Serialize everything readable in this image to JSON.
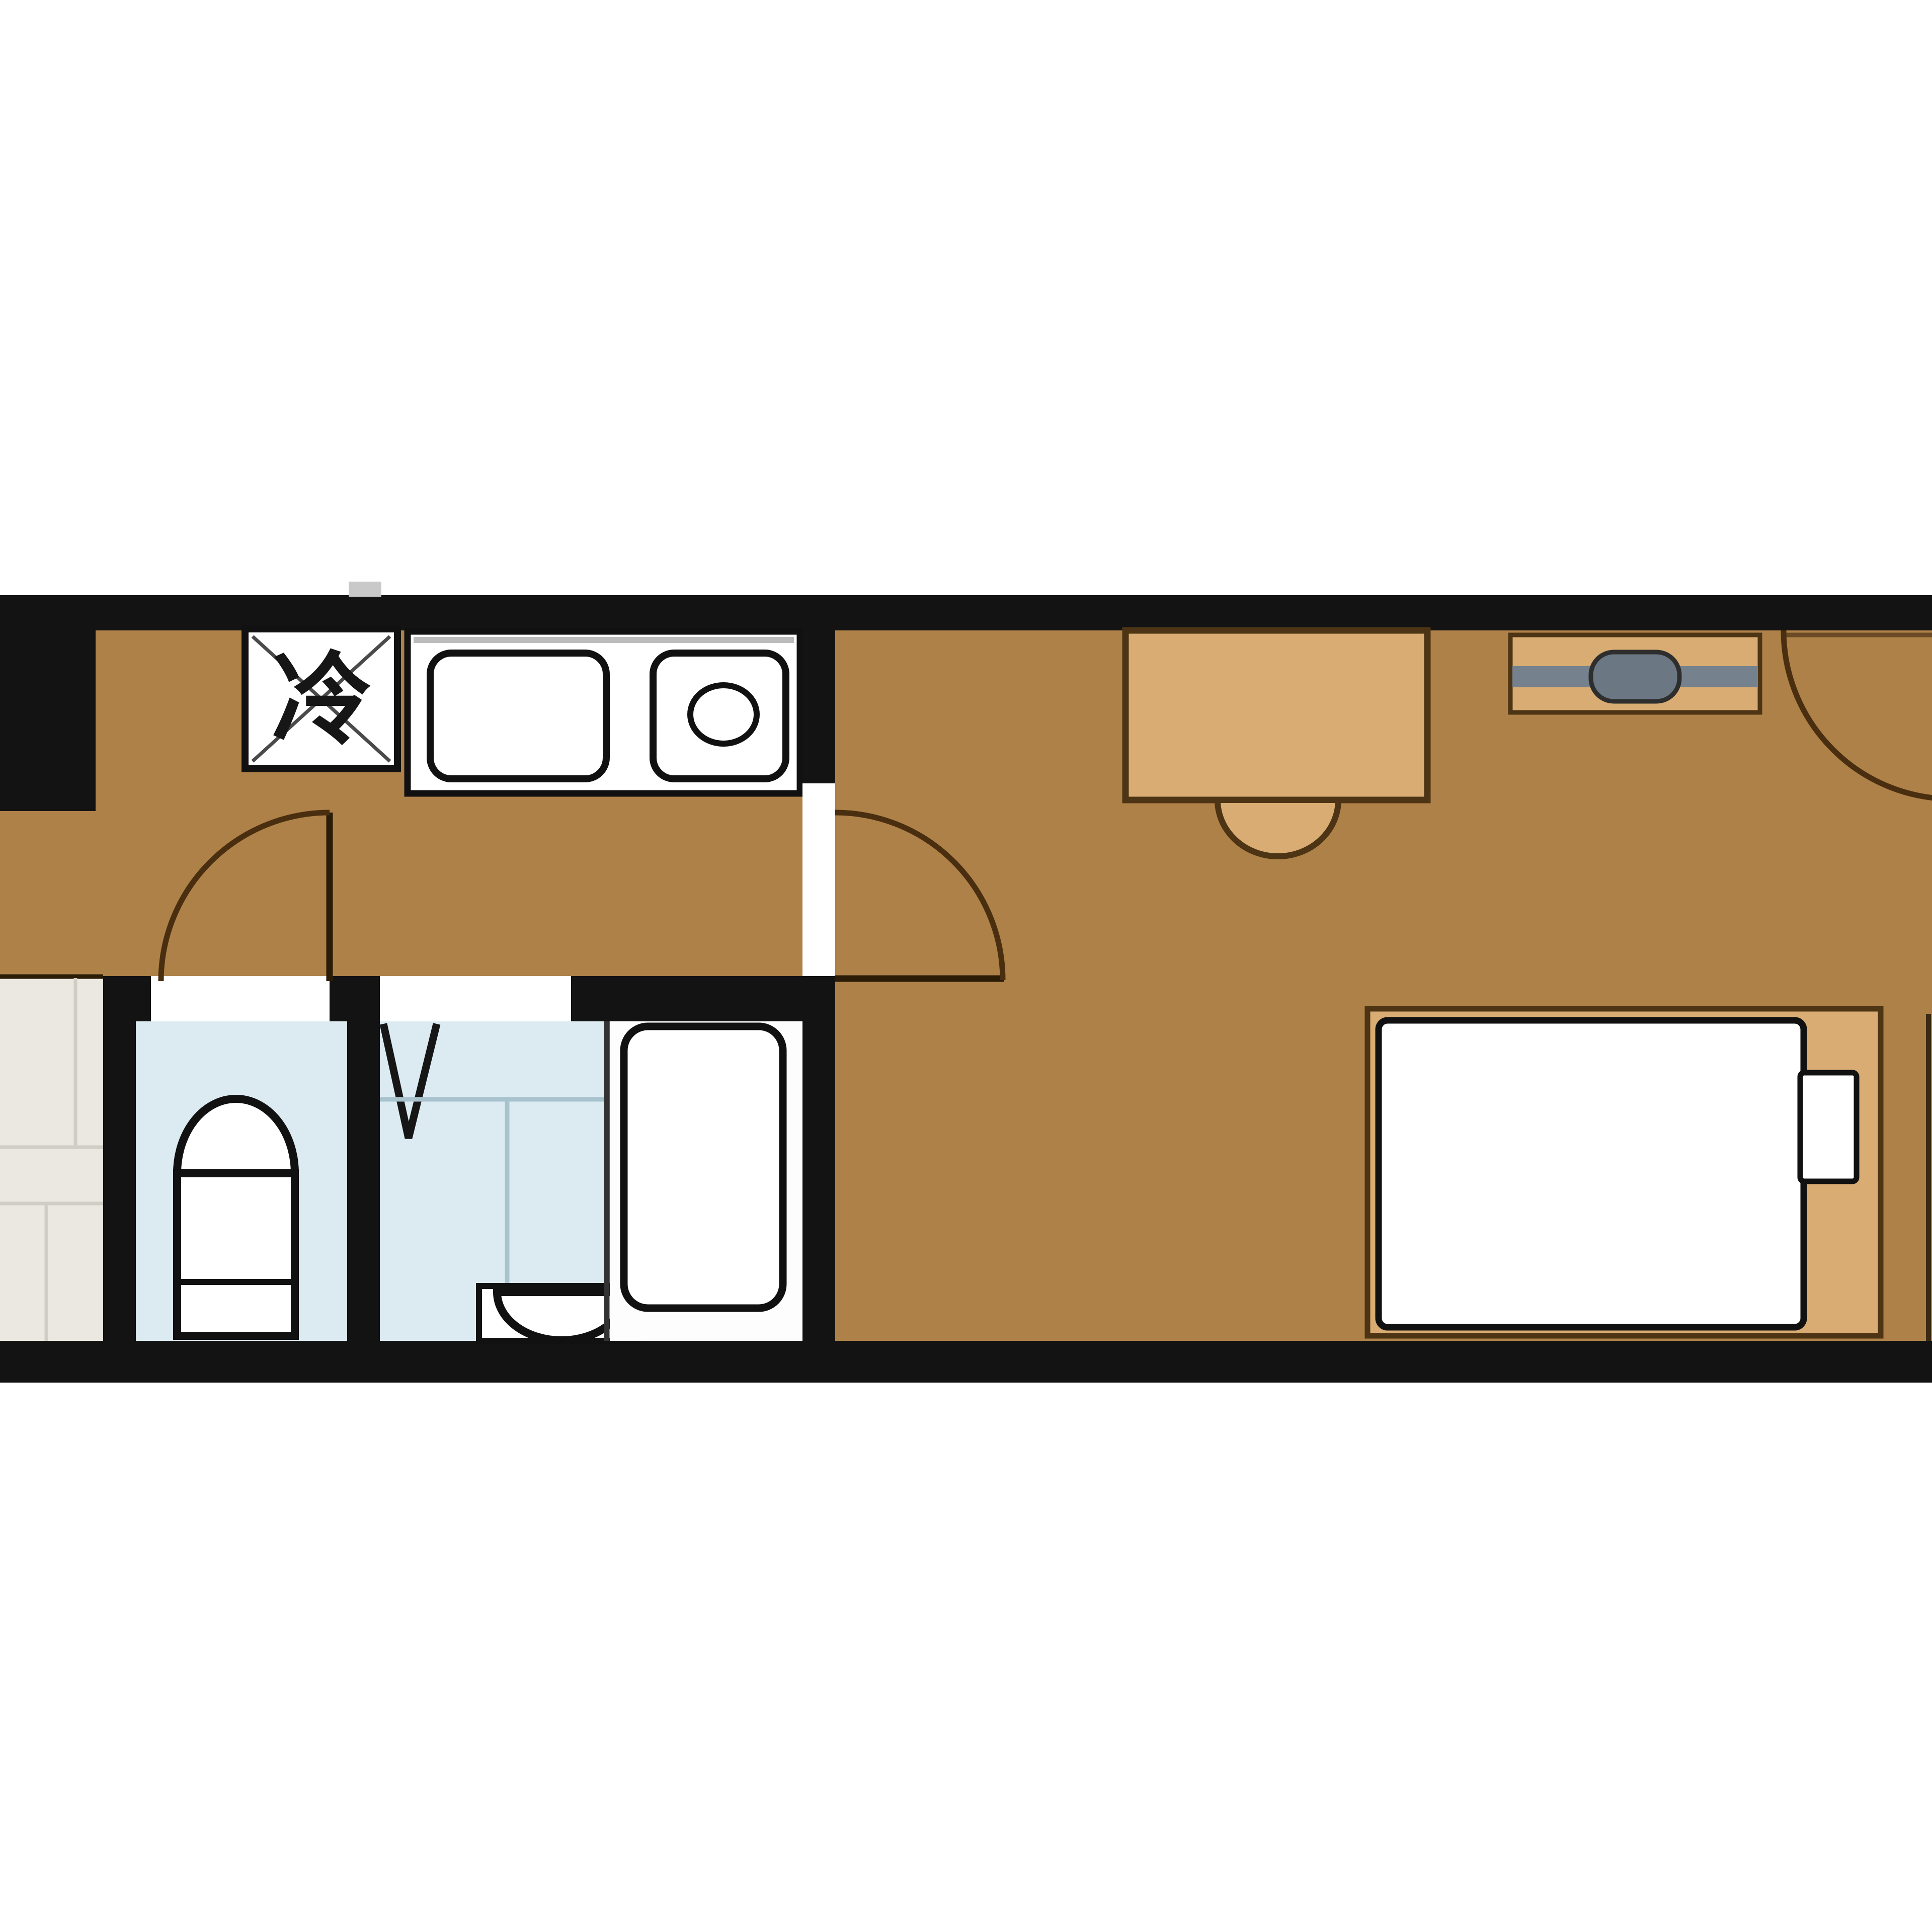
{
  "labels": {
    "refrigerator": "冷"
  },
  "colors": {
    "background": "#ffffff",
    "wall": "#131313",
    "floor": "#ae8148",
    "furniture": "#d8ac72",
    "furniture_border": "#4d3414",
    "door_arc": "#4a2e10",
    "wet_area": "#dcebf1",
    "wet_line": "#a9c3ce",
    "bath_floor": "#fdfdfd",
    "fixture": "#ffffff",
    "fixture_border": "#111111",
    "tile": "#ebe8e1",
    "tile_line": "#d0cdc5",
    "hanger_bar": "#75818d",
    "hanger_slider": "#6b7884",
    "counter_edge": "#bcbcbc",
    "dark_line": "#2b1c08",
    "sill": "#6b4a26",
    "notch": "#c9c9c9"
  }
}
